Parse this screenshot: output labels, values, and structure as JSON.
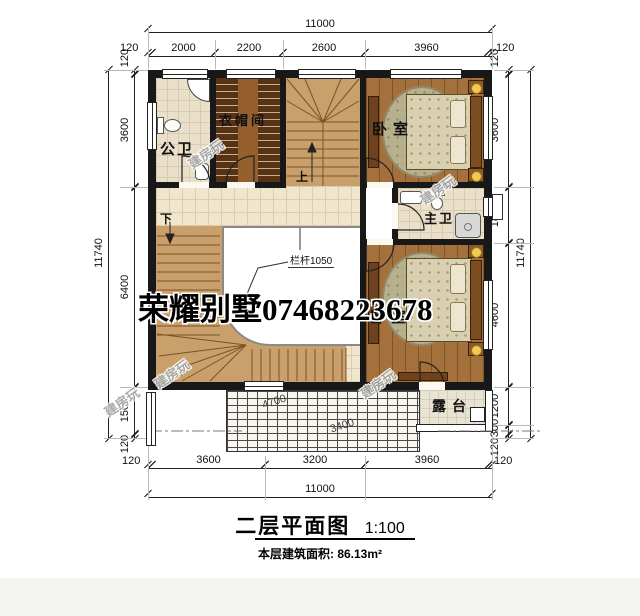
{
  "title": {
    "main": "二层平面图",
    "scale": "1:100",
    "area": "本层建筑面积: 86.13m²"
  },
  "watermark": {
    "center": "荣耀别墅07468223678",
    "small": "建房玩"
  },
  "rooms": {
    "public_bath": "公卫",
    "cloakroom": "衣帽间",
    "bedroom_top": "卧室",
    "master_bath": "主卫",
    "bedroom_bottom": "卧室",
    "terrace": "露台"
  },
  "stairs": {
    "up": "上",
    "down": "下",
    "railing_note": "栏杆1050"
  },
  "roof_notes": {
    "n1": "4700",
    "n2": "3400"
  },
  "dims": {
    "top": {
      "total": "11000",
      "s1": "2000",
      "s2": "2200",
      "s3": "2600",
      "s4": "3960",
      "left120": "120",
      "right120": "120"
    },
    "bottom": {
      "total": "11000",
      "s1": "3600",
      "s2": "3200",
      "s3": "3960",
      "left120": "120",
      "right120": "120"
    },
    "left": {
      "total": "11740",
      "t120": "120",
      "s1": "3600",
      "s2": "6400",
      "s3": "1500",
      "b120": "120"
    },
    "right": {
      "total": "11740",
      "t120": "120",
      "s1": "3600",
      "s2": "1800",
      "s3": "4600",
      "s4": "1200",
      "s5": "300",
      "b120": "120"
    }
  }
}
